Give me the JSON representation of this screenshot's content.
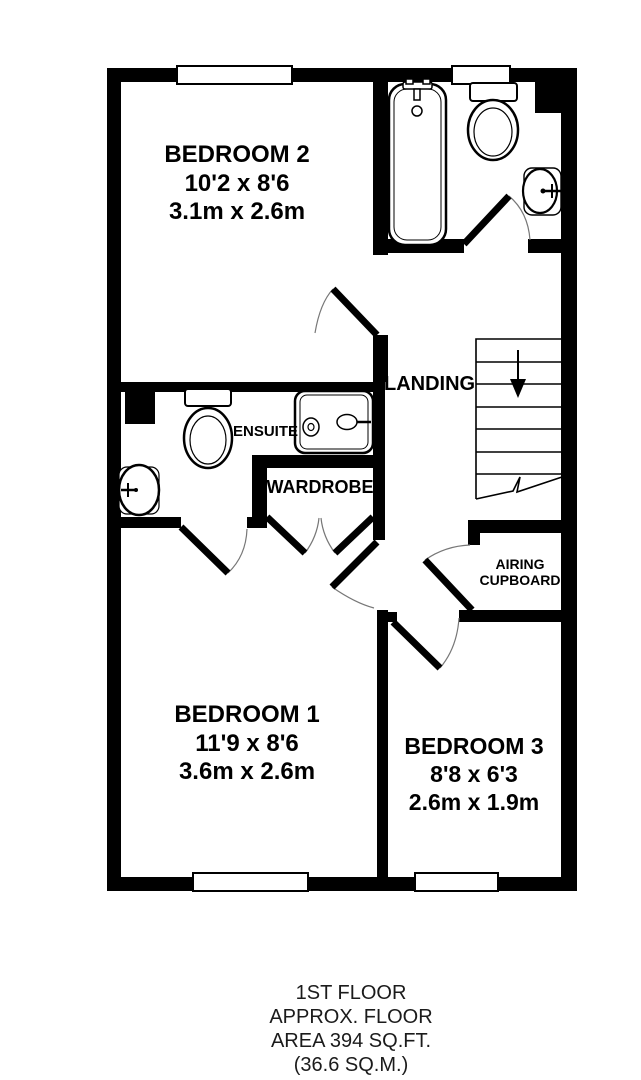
{
  "floor_plan": {
    "title": "1st floor plan",
    "rooms": {
      "bedroom2": {
        "name": "BEDROOM 2",
        "size_imperial": "10'2 x 8'6",
        "size_metric": "3.1m x 2.6m"
      },
      "bedroom1": {
        "name": "BEDROOM 1",
        "size_imperial": "11'9 x 8'6",
        "size_metric": "3.6m x 2.6m"
      },
      "bedroom3": {
        "name": "BEDROOM 3",
        "size_imperial": "8'8 x 6'3",
        "size_metric": "2.6m x 1.9m"
      },
      "landing": {
        "name": "LANDING"
      },
      "ensuite": {
        "name": "ENSUITE"
      },
      "wardrobe": {
        "name": "WARDROBE"
      },
      "airing_cupboard": {
        "line1": "AIRING",
        "line2": "CUPBOARD"
      }
    },
    "fixtures": {
      "bathroom": [
        "bathtub-icon",
        "toilet-icon",
        "sink-icon"
      ],
      "ensuite": [
        "toilet-icon",
        "shower-icon",
        "sink-icon"
      ],
      "stairs": "stairs-down-arrow-icon"
    },
    "colors": {
      "wall": "#000000",
      "background": "#ffffff",
      "label_text": "#000000",
      "footer_text": "#1b1b1b",
      "door_arc": "#777777"
    },
    "footer": {
      "line1": "1ST FLOOR",
      "line2": "APPROX. FLOOR",
      "line3": "AREA 394 SQ.FT.",
      "line4": "(36.6 SQ.M.)"
    }
  }
}
